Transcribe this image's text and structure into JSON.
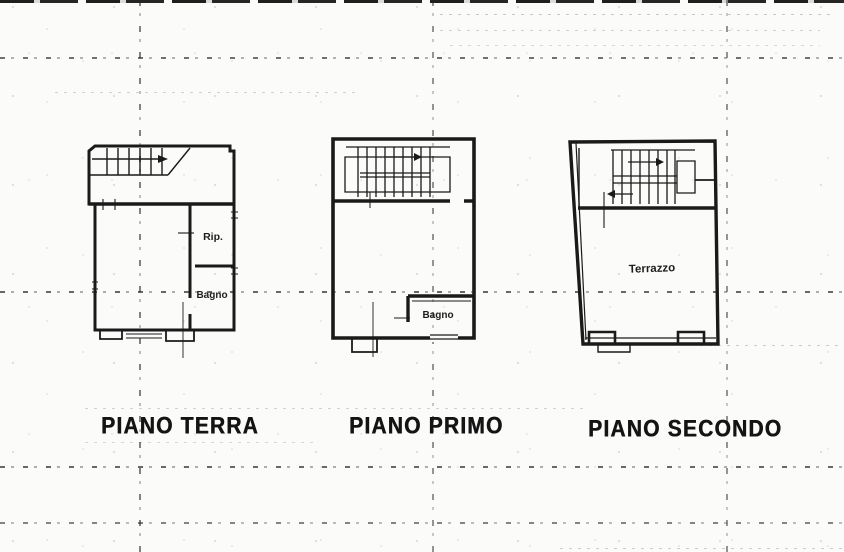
{
  "page": {
    "paper_color": "#fbfbf9",
    "ink_color": "#1a1a1a"
  },
  "icons": {
    "stair_direction": "arrow-right"
  },
  "plans": [
    {
      "caption": "PIANO TERRA",
      "rooms": [
        {
          "label": "Rip."
        },
        {
          "label": "Bagno"
        }
      ]
    },
    {
      "caption": "PIANO PRIMO",
      "rooms": [
        {
          "label": "Bagno"
        }
      ]
    },
    {
      "caption": "PIANO SECONDO",
      "rooms": [
        {
          "label": "Terrazzo"
        }
      ]
    }
  ]
}
